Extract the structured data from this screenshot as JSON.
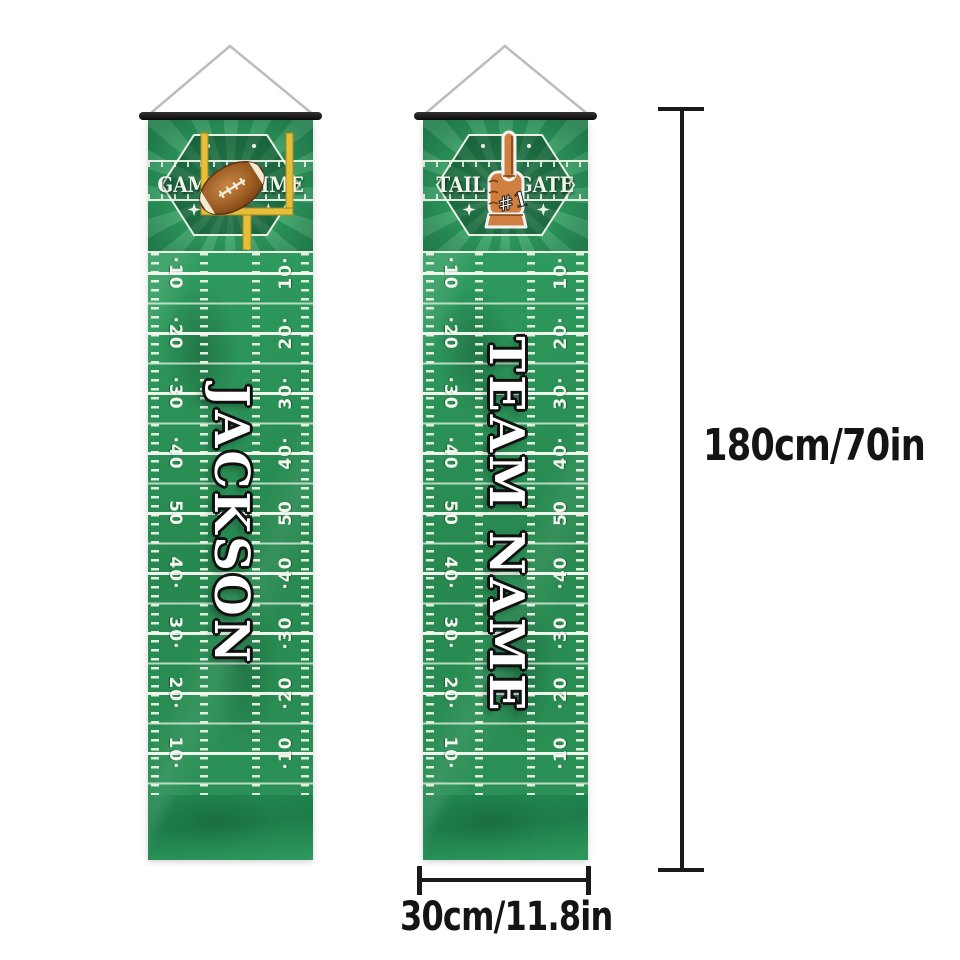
{
  "banners": {
    "left": {
      "header": {
        "word_left": "GAME",
        "word_right": "TIME",
        "icon": "goalpost-football"
      },
      "name": "JACKSON"
    },
    "right": {
      "header": {
        "word_left": "TAIL",
        "word_right": "GATE",
        "icon": "foam-finger",
        "finger_text": "#1"
      },
      "name": "TEAM NAME"
    }
  },
  "field": {
    "labels_left": [
      "·10",
      "·20",
      "·30",
      "·40",
      "50",
      "40·",
      "30·",
      "20·",
      "10·"
    ],
    "labels_right": [
      "10·",
      "20·",
      "30·",
      "40·",
      "50",
      "·40",
      "·30",
      "·20",
      "·10"
    ]
  },
  "dimensions": {
    "height_label": "180cm/70in",
    "width_label": "30cm/11.8in"
  },
  "colors": {
    "field_green": "#2b9156",
    "ray_green": "#4bb076",
    "line_white": "#f2f6ee",
    "post_yellow": "#e5be3a",
    "football_brown": "#8a4d1e",
    "foam_orange": "#cf8040",
    "dimension_black": "#1a1a1a"
  }
}
